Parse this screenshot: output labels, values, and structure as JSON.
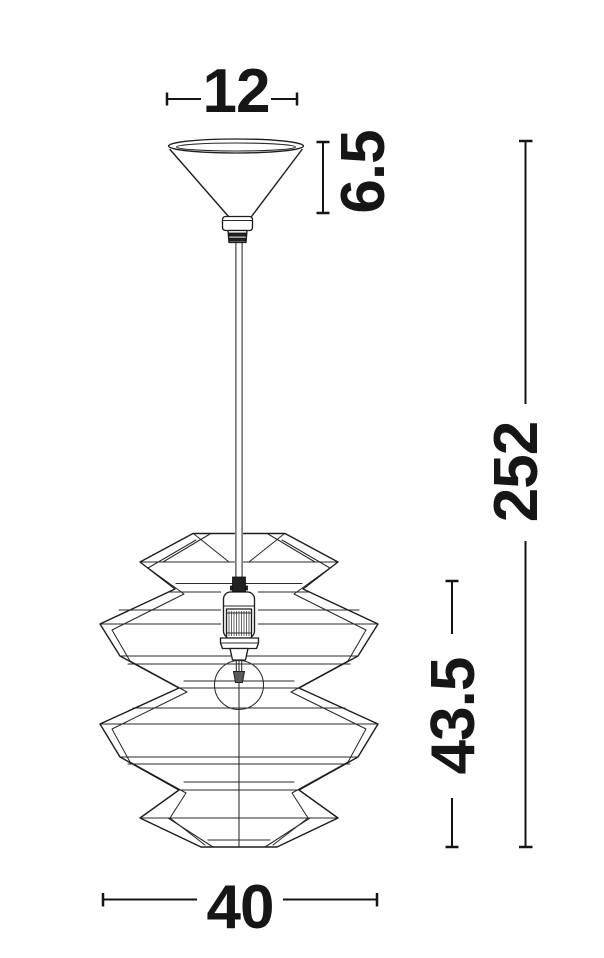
{
  "page": {
    "background": "#ffffff",
    "line_color": "#1d1d1d",
    "dimension_color": "#141414"
  },
  "drawing": {
    "type": "technical-dimension-drawing",
    "subject": "pendant-lamp-with-zigzag-wireframe-shade",
    "parts": [
      "ceiling-canopy-cone",
      "strain-relief",
      "power-cord",
      "lamp-socket",
      "light-bulb",
      "zigzag-wireframe-shade"
    ],
    "dimensions": {
      "canopy_width": {
        "value": "12",
        "orientation": "horizontal",
        "location": "top"
      },
      "canopy_height": {
        "value": "6.5",
        "orientation": "vertical",
        "location": "upper-right-of-canopy"
      },
      "total_height": {
        "value": "252",
        "orientation": "vertical",
        "location": "far-right"
      },
      "shade_height": {
        "value": "43.5",
        "orientation": "vertical",
        "location": "right-of-shade"
      },
      "shade_width": {
        "value": "40",
        "orientation": "horizontal",
        "location": "bottom"
      }
    }
  }
}
